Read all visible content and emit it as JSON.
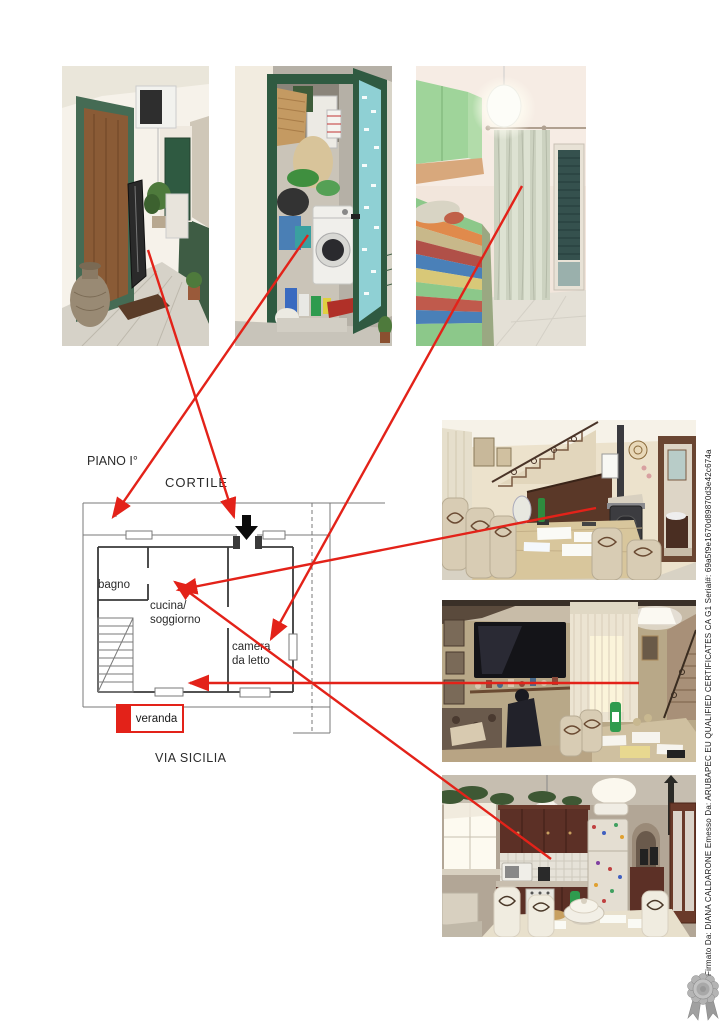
{
  "document": {
    "type_note": "floor plan photo annex page",
    "background": "#ffffff"
  },
  "floor_plan": {
    "floor_label": "PIANO I°",
    "courtyard_label": "CORTILE",
    "street_label": "VIA SICILIA",
    "room_bathroom": "bagno",
    "room_kitchen_line1": "cucina/",
    "room_kitchen_line2": "soggiorno",
    "room_bedroom_line1": "camera",
    "room_bedroom_line2": "da letto",
    "room_veranda": "veranda"
  },
  "photos": [
    {
      "id": "balcony-corridor",
      "position": "top-left"
    },
    {
      "id": "storage-room-with-washing-machine",
      "position": "top-center"
    },
    {
      "id": "bedroom",
      "position": "top-right"
    },
    {
      "id": "dining-room-with-staircase",
      "position": "right-upper"
    },
    {
      "id": "living-room-with-tv",
      "position": "right-middle"
    },
    {
      "id": "kitchen",
      "position": "right-lower"
    }
  ],
  "signature_stamp": {
    "text": "Firmato Da: DIANA CALDARONE Emesso Da: ARUBAPEC EU QUALIFIED CERTIFICATES CA G1 Serial#: 69a5f9e1670d89870d3e42c674a"
  },
  "colors": {
    "arrow_red": "#e32219",
    "plan_wall": "#3a3a3a",
    "plan_light": "#7a7a7a",
    "entrance_arrow": "#0a0a0a",
    "seal_gray": "#aaaaaa"
  }
}
